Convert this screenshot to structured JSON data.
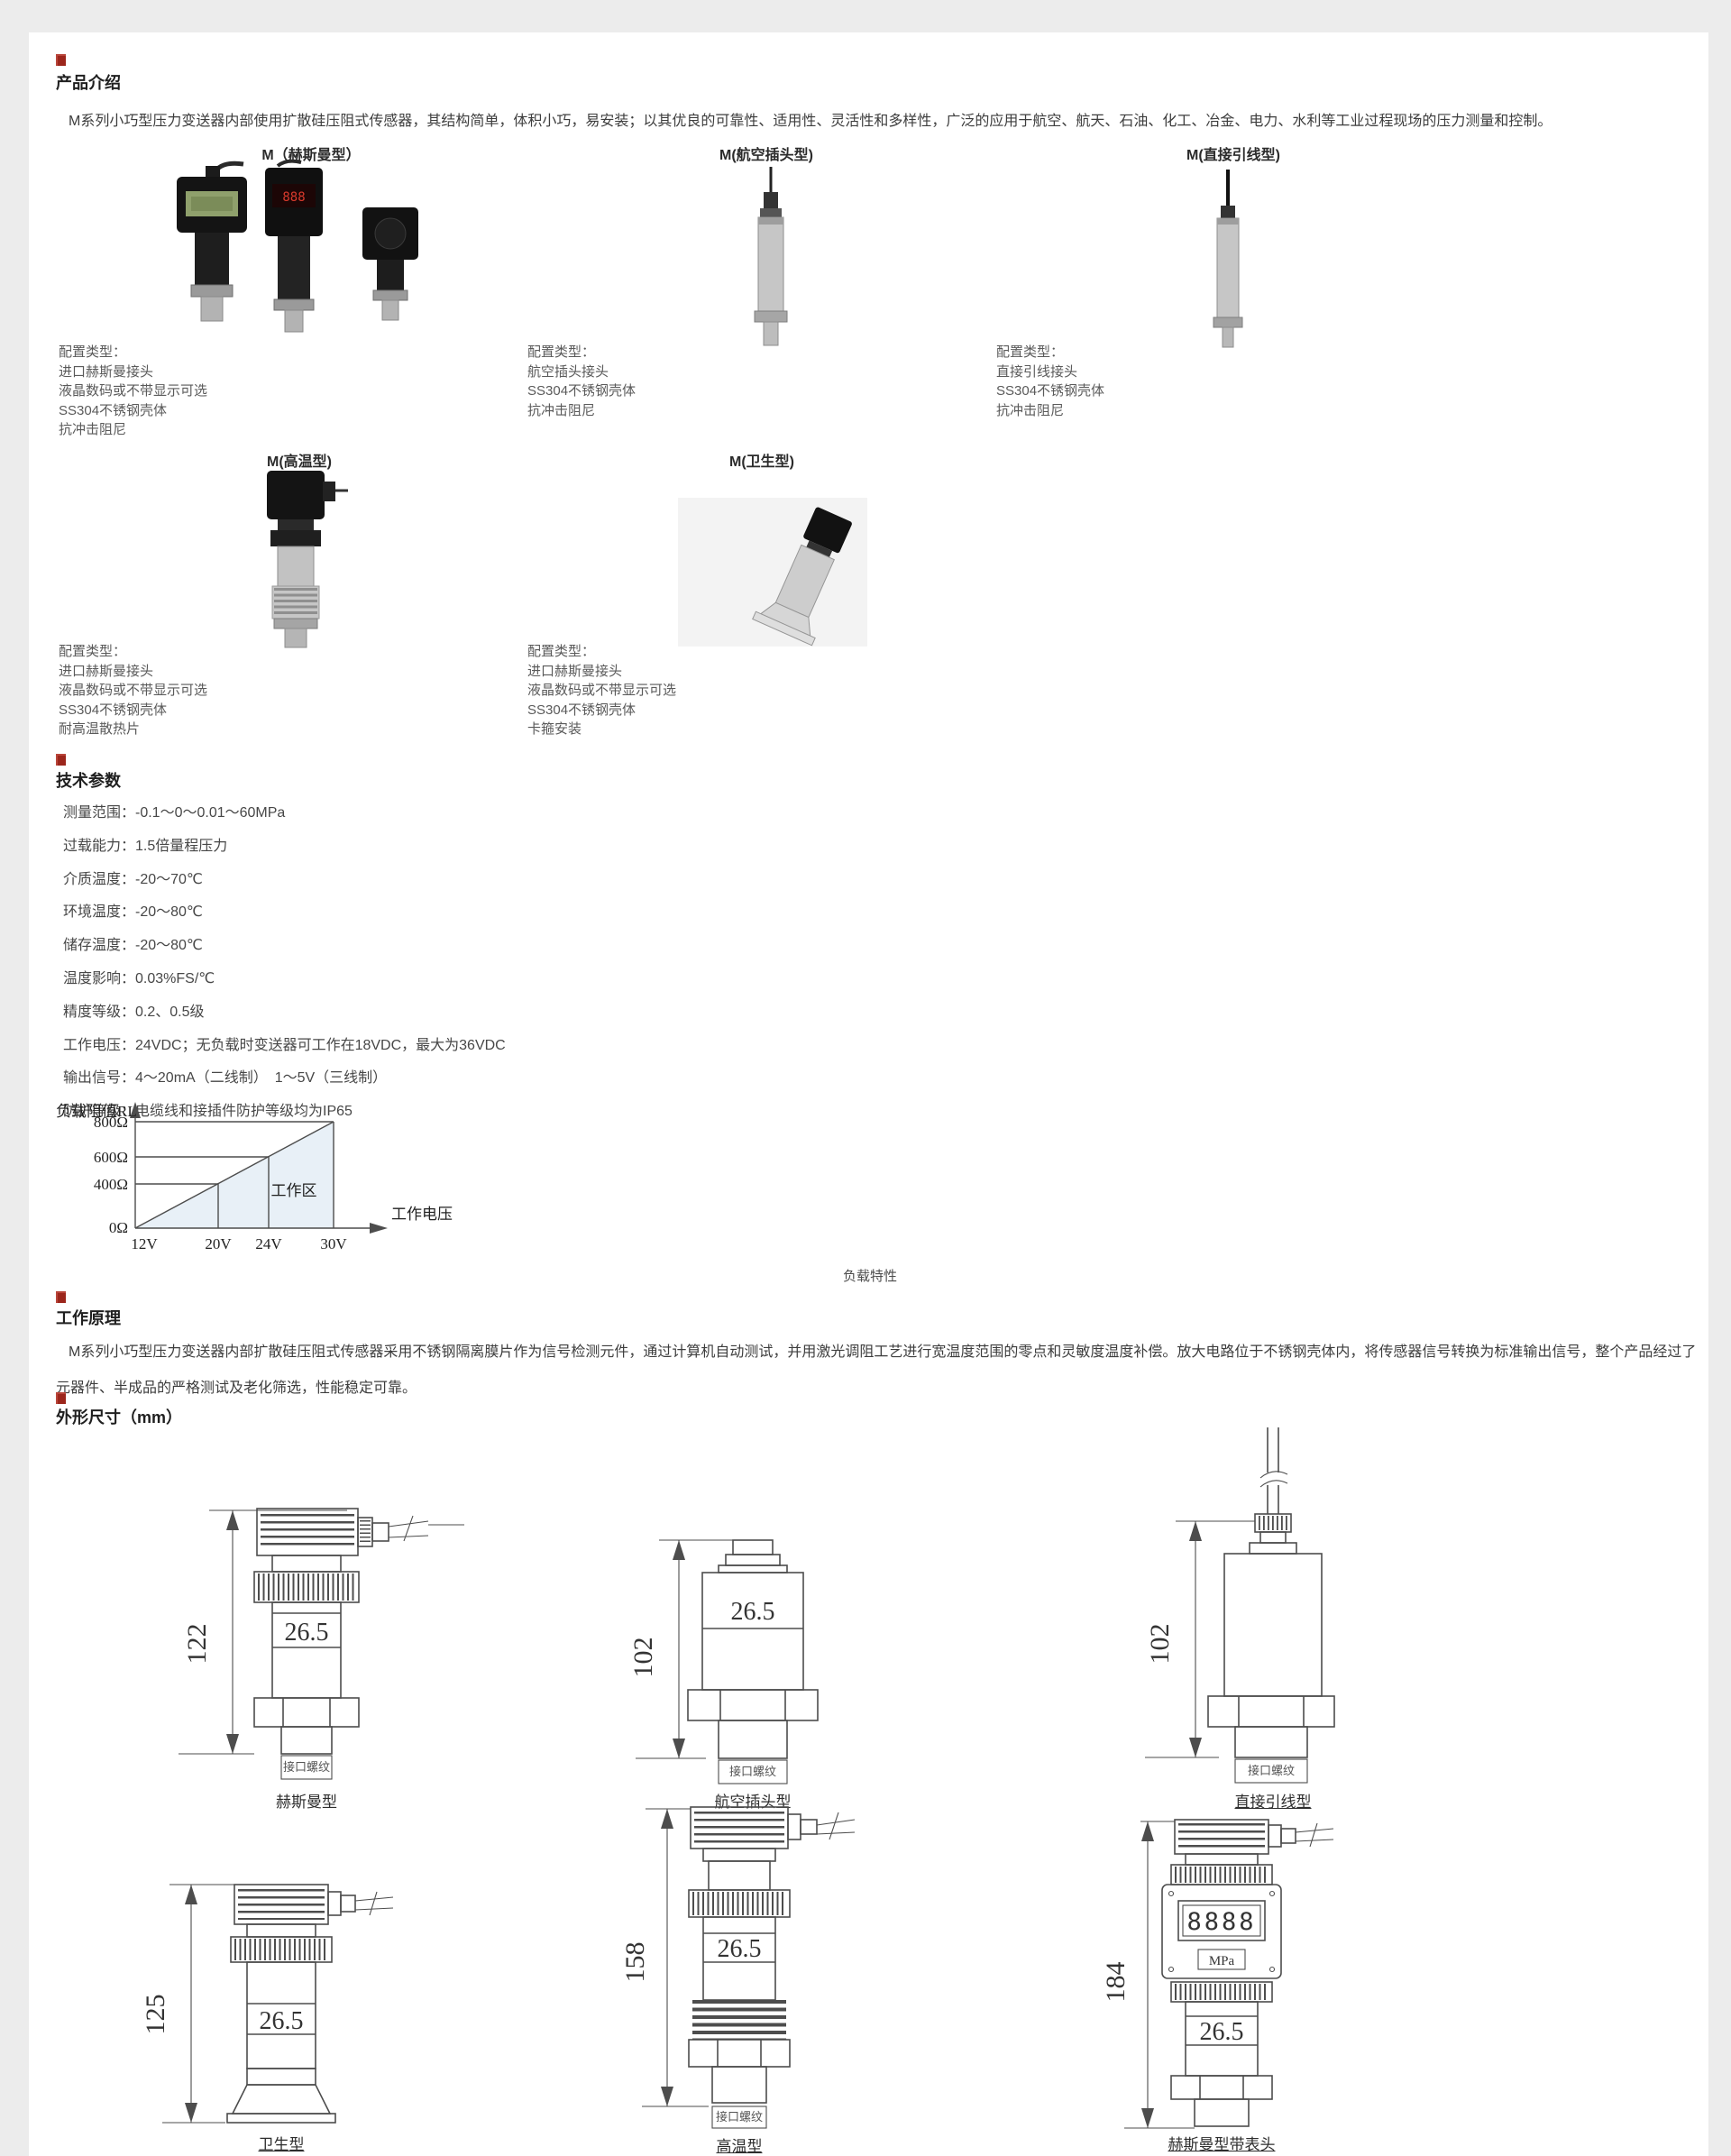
{
  "page": {
    "bg": "#ececec",
    "content_bg": "#ffffff",
    "accent_red": "#9c261c"
  },
  "sections": {
    "intro": {
      "heading": "产品介绍",
      "body": "M系列小巧型压力变送器内部使用扩散硅压阻式传感器，其结构简单，体积小巧，易安装；以其优良的可靠性、适用性、灵活性和多样性，广泛的应用于航空、航天、石油、化工、冶金、电力、水利等工业过程现场的压力测量和控制。"
    },
    "products": {
      "row1": [
        {
          "title": "M（赫斯曼型）",
          "config": [
            "配置类型：",
            "进口赫斯曼接头",
            "液晶数码或不带显示可选",
            "SS304不锈钢壳体",
            "抗冲击阻尼"
          ]
        },
        {
          "title": "M(航空插头型)",
          "config": [
            "配置类型：",
            "航空插头接头",
            "SS304不锈钢壳体",
            "抗冲击阻尼"
          ]
        },
        {
          "title": "M(直接引线型)",
          "config": [
            "配置类型：",
            "直接引线接头",
            "SS304不锈钢壳体",
            "抗冲击阻尼"
          ]
        }
      ],
      "row2": [
        {
          "title": "M(高温型)",
          "config": [
            "配置类型：",
            "进口赫斯曼接头",
            "液晶数码或不带显示可选",
            "SS304不锈钢壳体",
            "耐高温散热片"
          ]
        },
        {
          "title": "M(卫生型)",
          "config": [
            "配置类型：",
            "进口赫斯曼接头",
            "液晶数码或不带显示可选",
            "SS304不锈钢壳体",
            "卡箍安装"
          ]
        }
      ]
    },
    "tech": {
      "heading": "技术参数",
      "params": [
        "测量范围：-0.1～0～0.01～60MPa",
        "过载能力：1.5倍量程压力",
        "介质温度：-20～70℃",
        "环境温度：-20～80℃",
        "储存温度：-20～80℃",
        "温度影响：0.03%FS/℃",
        "精度等级：0.2、0.5级",
        "工作电压：24VDC；无负载时变送器可工作在18VDC，最大为36VDC",
        "输出信号：4～20mA（二线制）　1～5V（三线制）",
        "防护等级：电缆线和接插件防护等级均为IP65"
      ]
    },
    "principle": {
      "heading": "工作原理",
      "body": "M系列小巧型压力变送器内部扩散硅压阻式传感器采用不锈钢隔离膜片作为信号检测元件，通过计算机自动测试，并用激光调阻工艺进行宽温度范围的零点和灵敏度温度补偿。放大电路位于不锈钢壳体内，将传感器信号转换为标准输出信号，整个产品经过了元器件、半成品的严格测试及老化筛选，性能稳定可靠。"
    },
    "dimensions": {
      "heading": "外形尺寸（mm）"
    }
  },
  "chart_data": {
    "type": "line",
    "title": "负载特性",
    "ylabel": "负载阻值RL",
    "xlabel": "工作电压",
    "x_ticks": [
      "12V",
      "20V",
      "24V",
      "30V"
    ],
    "y_ticks": [
      "800Ω",
      "600Ω",
      "400Ω",
      "0Ω"
    ],
    "points": [
      {
        "x": 12,
        "y": 0
      },
      {
        "x": 20,
        "y": 400
      },
      {
        "x": 24,
        "y": 600
      },
      {
        "x": 30,
        "y": 800
      }
    ],
    "region_label": "工作区",
    "region_fill": "#e8f0f7",
    "xlim": [
      12,
      30
    ],
    "ylim": [
      0,
      800
    ],
    "grid": false
  },
  "drawings": [
    {
      "caption": "赫斯曼型",
      "height": "122",
      "width": "26.5",
      "thread": "接口螺纹"
    },
    {
      "caption": "航空插头型",
      "height": "102",
      "width": "26.5",
      "thread": "接口螺纹"
    },
    {
      "caption": "直接引线型",
      "height": "102",
      "thread": "接口螺纹"
    },
    {
      "caption": "卫生型",
      "height": "125",
      "width": "26.5"
    },
    {
      "caption": "高温型",
      "height": "158",
      "width": "26.5",
      "thread": "接口螺纹"
    },
    {
      "caption": "赫斯曼型带表头",
      "height": "184",
      "width": "26.5",
      "display": "8888",
      "unit": "MPa"
    }
  ]
}
